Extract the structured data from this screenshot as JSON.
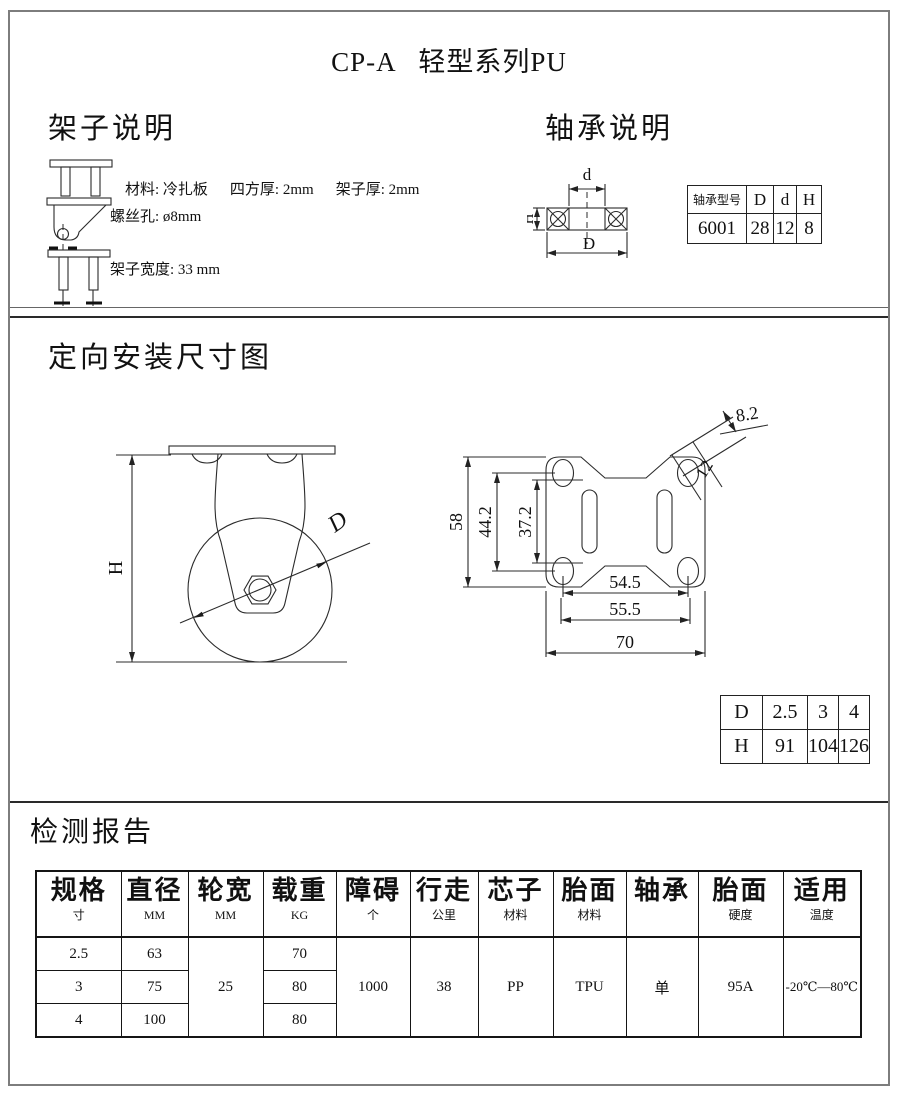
{
  "page": {
    "title": "CP-A   轻型系列PU"
  },
  "frame_section": {
    "heading": "架子说明",
    "item1": {
      "p1": "材料: 冷扎板",
      "p2": "四方厚: 2mm",
      "p3": "架子厚: 2mm"
    },
    "item2": "螺丝孔: ø8mm",
    "item3": "架子宽度: 33 mm"
  },
  "bearing_section": {
    "heading": "轴承说明",
    "diagram": {
      "d": "d",
      "h": "H",
      "dd": "D"
    },
    "table": {
      "model_header": "轴承型号",
      "col_d": "D",
      "col_ds": "d",
      "col_h": "H",
      "model": "6001",
      "val_d": "28",
      "val_ds": "12",
      "val_h": "8"
    }
  },
  "mounting_section": {
    "heading": "定向安装尺寸图",
    "side_view": {
      "h": "H",
      "d": "D"
    },
    "plate_view": {
      "height": "58",
      "hole_span_v": "44.2",
      "inner_span_v": "37.2",
      "hole_span_h": "54.5",
      "outer_span_h": "55.5",
      "width": "70",
      "hole_w": "8.2",
      "hole_l": "12"
    },
    "dh_table": {
      "row_d": [
        "D",
        "2.5",
        "3",
        "4"
      ],
      "row_h": [
        "H",
        "91",
        "104",
        "126"
      ]
    }
  },
  "report_section": {
    "heading": "检测报告",
    "headers": [
      {
        "main": "规格",
        "sub": "寸"
      },
      {
        "main": "直径",
        "sub": "MM"
      },
      {
        "main": "轮宽",
        "sub": "MM"
      },
      {
        "main": "载重",
        "sub": "KG"
      },
      {
        "main": "障碍",
        "sub": "个"
      },
      {
        "main": "行走",
        "sub": "公里"
      },
      {
        "main": "芯子",
        "sub": "材料"
      },
      {
        "main": "胎面",
        "sub": "材料"
      },
      {
        "main": "轴承",
        "sub": ""
      },
      {
        "main": "胎面",
        "sub": "硬度"
      },
      {
        "main": "适用",
        "sub": "温度"
      }
    ],
    "rows": [
      {
        "size": "2.5",
        "diameter": "63",
        "load": "70"
      },
      {
        "size": "3",
        "diameter": "75",
        "load": "80"
      },
      {
        "size": "4",
        "diameter": "100",
        "load": "80"
      }
    ],
    "merged": {
      "wheel_width": "25",
      "obstacles": "1000",
      "distance": "38",
      "core": "PP",
      "tread": "TPU",
      "bearing": "单",
      "hardness": "95A",
      "temperature": "-20℃—80℃"
    }
  }
}
